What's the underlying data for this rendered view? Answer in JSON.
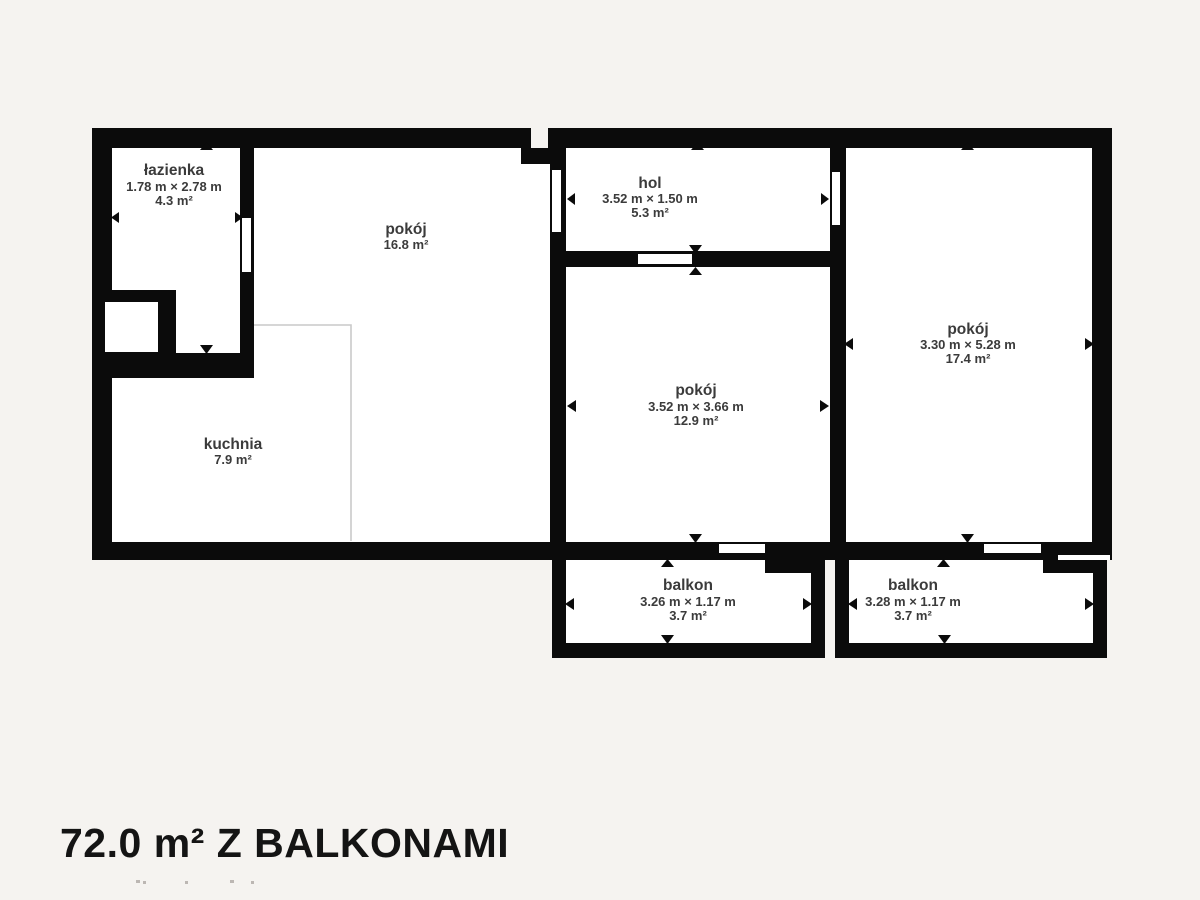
{
  "page": {
    "title_label": "72.0 m² Z BALKONAMI"
  },
  "colors": {
    "background": "#f5f3f0",
    "wall": "#0b0b0b",
    "room_fill": "#ffffff",
    "label_text": "#3b3b3b",
    "title_text": "#141414",
    "kitchen_boundary_line": "#c9c9c9"
  },
  "rooms": [
    {
      "id": "lazienka",
      "name": "łazienka",
      "dims": "1.78 m × 2.78 m",
      "area": "4.3 m²"
    },
    {
      "id": "pokoj-left",
      "name": "pokój",
      "dims": "",
      "area": "16.8 m²"
    },
    {
      "id": "hol",
      "name": "hol",
      "dims": "3.52 m × 1.50 m",
      "area": "5.3 m²"
    },
    {
      "id": "pokoj-middle",
      "name": "pokój",
      "dims": "3.52 m × 3.66 m",
      "area": "12.9 m²"
    },
    {
      "id": "pokoj-right",
      "name": "pokój",
      "dims": "3.30 m × 5.28 m",
      "area": "17.4 m²"
    },
    {
      "id": "kuchnia",
      "name": "kuchnia",
      "dims": "",
      "area": "7.9 m²"
    },
    {
      "id": "balkon-left",
      "name": "balkon",
      "dims": "3.26 m × 1.17 m",
      "area": "3.7 m²"
    },
    {
      "id": "balkon-right",
      "name": "balkon",
      "dims": "3.28 m × 1.17 m",
      "area": "3.7 m²"
    }
  ]
}
